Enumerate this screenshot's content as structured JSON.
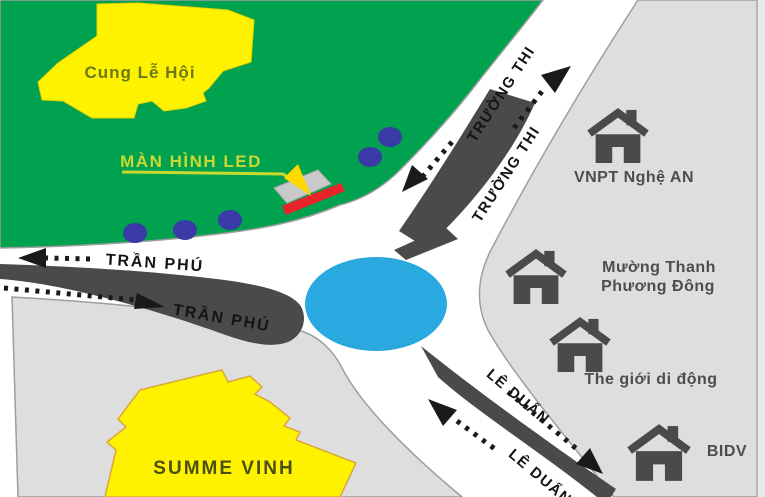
{
  "park": {
    "name": "Cung Lễ Hội"
  },
  "led_screen": {
    "label": "MÀN HÌNH LED"
  },
  "roads": {
    "tran_phu_upper": "TRẦN PHÚ",
    "tran_phu_lower": "TRẦN PHÚ",
    "truong_thi_inner": "TRƯỜNG THI",
    "truong_thi_outer": "TRƯỜNG THI",
    "le_duan_right": "LÊ DUẨN",
    "le_duan_left": "LÊ DUẨN"
  },
  "buildings": {
    "summe_vinh": "SUMME VINH"
  },
  "landmarks": {
    "vnpt": "VNPT Nghệ AN",
    "muong_thanh_line1": "Mường Thanh",
    "muong_thanh_line2": "Phương Đông",
    "the_gioi_di_dong": "The giới di động",
    "bidv": "BIDV"
  },
  "colors": {
    "park_green": "#00a14f",
    "area_gray": "#dedede",
    "building_yellow": "#fff200",
    "roundabout_blue": "#29a9e0",
    "marker_gray": "#4a4a4a",
    "tree_blue": "#3a3aa6",
    "led_red": "#e8232a",
    "led_screen_gray": "#c9c9c9",
    "led_label_green": "#c9d930",
    "arrow_yellow": "#ffd800"
  }
}
